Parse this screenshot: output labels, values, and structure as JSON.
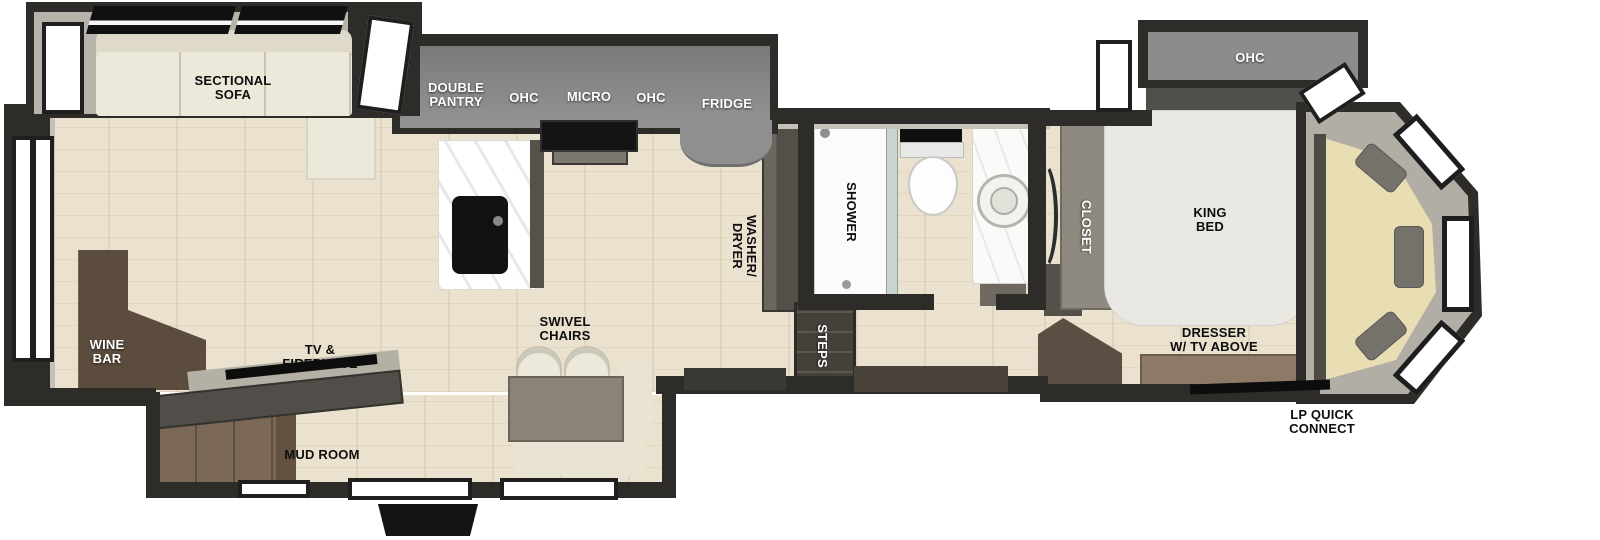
{
  "floorplan": {
    "type": "rv-fifth-wheel-floorplan",
    "labels": {
      "sectional_sofa": "SECTIONAL\nSOFA",
      "double_pantry": "DOUBLE\nPANTRY",
      "ohc_left": "OHC",
      "micro": "MICRO",
      "ohc_right": "OHC",
      "fridge": "FRIDGE",
      "washer_dryer": "WASHER/\nDRYER",
      "shower": "SHOWER",
      "steps": "STEPS",
      "closet": "CLOSET",
      "ohc_bedroom": "OHC",
      "king_bed": "KING\nBED",
      "dresser": "DRESSER\nW/ TV ABOVE",
      "lp_quick_connect": "LP QUICK\nCONNECT",
      "wine_bar": "WINE\nBAR",
      "tv_fireplace": "TV &\nFIREPLACE",
      "mud_room": "MUD ROOM",
      "swivel_chairs": "SWIVEL\nCHAIRS"
    },
    "colors": {
      "wall": "#2e2c29",
      "wall_lining": "#c5c1b8",
      "floor_wood": "#eae2ce",
      "cabinet_gray": "#8c8c8c",
      "sofa_cream": "#ece8da",
      "wine_bar_brown": "#5c4c3e",
      "mudroom_brown": "#7b6856",
      "dresser_brown": "#8d7a66",
      "front_bench_tan": "#e9ddb4",
      "label_dark": "#0e0e0e",
      "label_light": "#ffffff"
    }
  }
}
